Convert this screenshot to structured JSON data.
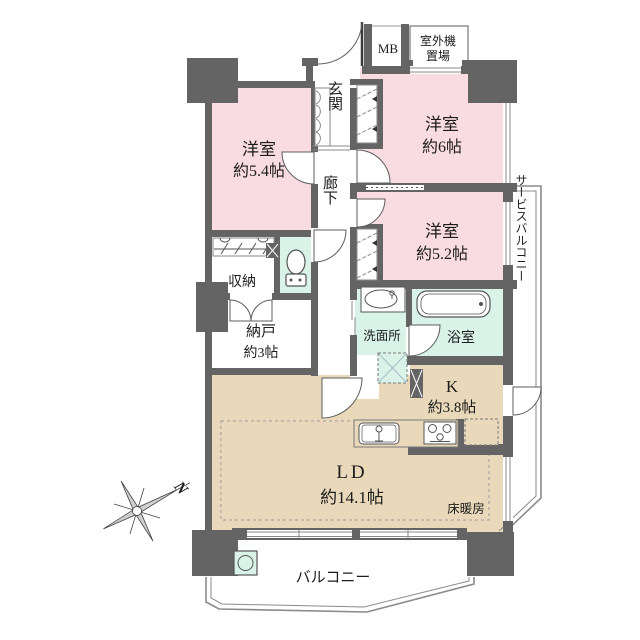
{
  "plan_type": "floorplan",
  "colors": {
    "wall": "#646464",
    "room_pink": "#f9dbe2",
    "room_mint": "#d9f3e9",
    "floor_beige": "#e9d9ba",
    "outline_gray": "#8a8a8a"
  },
  "rooms": {
    "bedroom_54": {
      "name": "洋室",
      "size": "約5.4帖"
    },
    "bedroom_6": {
      "name": "洋室",
      "size": "約6帖"
    },
    "bedroom_52": {
      "name": "洋室",
      "size": "約5.2帖"
    },
    "entrance": {
      "name": "玄関"
    },
    "hallway": {
      "name": "廊下"
    },
    "closet": {
      "name": "収納"
    },
    "storage": {
      "name": "納戸",
      "size": "約3帖"
    },
    "washroom": {
      "name": "洗面所"
    },
    "bathroom": {
      "name": "浴室"
    },
    "kitchen": {
      "name": "K",
      "size": "約3.8帖"
    },
    "living_dining": {
      "name": "LD",
      "size": "約14.1帖"
    },
    "balcony": {
      "name": "バルコニー"
    },
    "service_balcony": {
      "name": "サービスバルコニー"
    }
  },
  "labels": {
    "meter_box": "MB",
    "outdoor_unit_line1": "室外機",
    "outdoor_unit_line2": "置場",
    "floor_heating": "床暖房"
  },
  "compass": {
    "north_label": "N"
  }
}
